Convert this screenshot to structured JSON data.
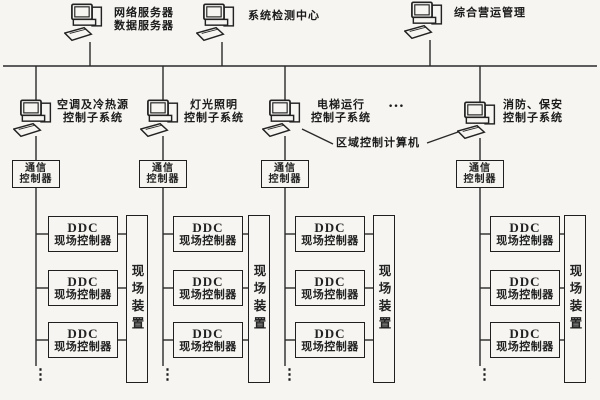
{
  "colors": {
    "ink": "#222222",
    "paper": "#f6f5f1"
  },
  "top_row": [
    {
      "line1": "网络服务器",
      "line2": "数据服务器"
    },
    {
      "line1": "系统检测中心",
      "line2": ""
    },
    {
      "line1": "综合营运管理",
      "line2": ""
    }
  ],
  "subsystems": [
    {
      "line1": "空调及冷热源",
      "line2": "控制子系统"
    },
    {
      "line1": "灯光照明",
      "line2": "控制子系统"
    },
    {
      "line1": "电梯运行",
      "line2": "控制子系统"
    },
    {
      "line1": "消防、保安",
      "line2": "控制子系统"
    }
  ],
  "ellipsis": "…",
  "area_control_computer": "区域控制计算机",
  "comm_controller": {
    "line1": "通信",
    "line2": "控制器"
  },
  "ddc": {
    "line1": "DDC",
    "line2": "现场控制器"
  },
  "field_device": "现场装置",
  "continuation": "⋮"
}
